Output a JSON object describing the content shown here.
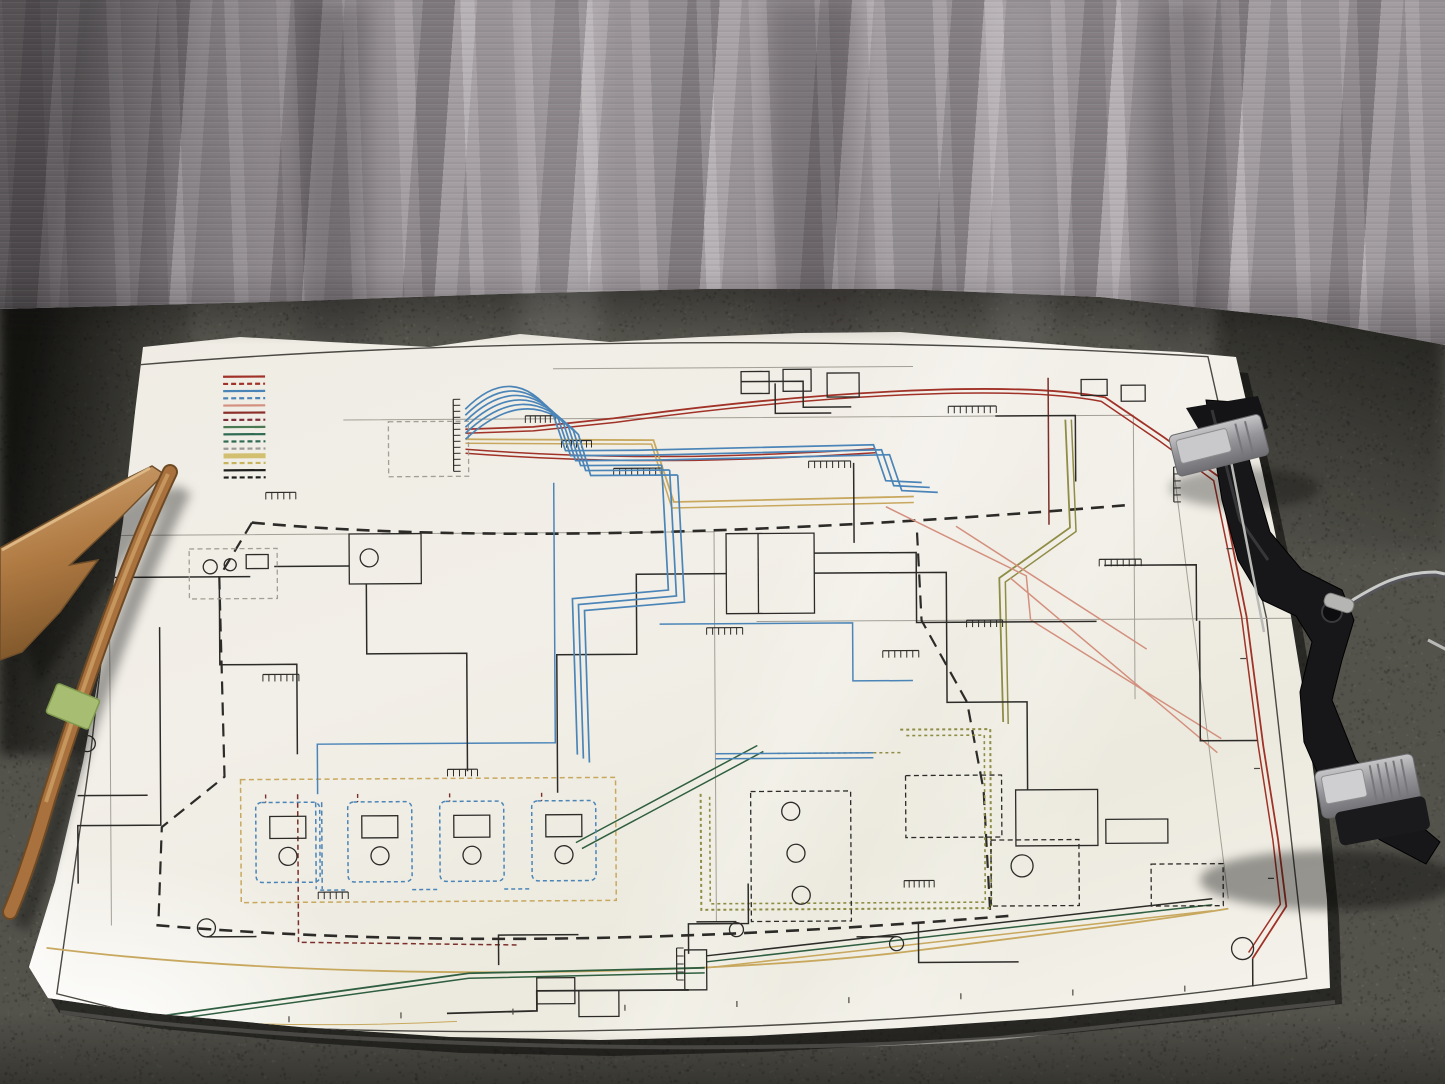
{
  "scene": {
    "type": "photograph",
    "subject": "Large color-coded electrical wiring schematic poster in a glossy plastic sleeve, laid on a dark carpeted floor in front of a gray drape curtain",
    "objects": [
      "wiring schematic poster",
      "gray woven curtain backdrop",
      "dark speckled carpet floor",
      "flat wooden slat",
      "long wooden stick with green tape band",
      "black plastic clamp hanger with two gray metal clips and silver swivel hook wire"
    ]
  },
  "palette": {
    "curtain_base": "#a19b9f",
    "curtain_fold_dark": "#8b8589",
    "curtain_fold_light": "#b3adb1",
    "carpet_base": "#53524b",
    "carpet_dark": "#34332e",
    "carpet_light": "#6b695f",
    "paper": "#f0ede6",
    "frame_line": "#4a4843",
    "wire_red": "#a03228",
    "wire_dark_red": "#7c2f2a",
    "wire_blue": "#4b85b8",
    "wire_tan": "#c8a85e",
    "wire_olive": "#8f8d45",
    "wire_green": "#2f5f40",
    "wire_pink": "#d4907e",
    "wire_black": "#2c2b28",
    "wire_gray": "#a29f96",
    "text_micro": "#8a887f",
    "wood_light": "#d2a877",
    "wood_mid": "#a9713d",
    "wood_dark": "#6e4a24",
    "tape_green": "#a6bd72",
    "hanger_black": "#17171a",
    "clip_metal": "#a8a8aa",
    "hook_metal": "#caccca"
  },
  "poster": {
    "kind": "machine electrical wiring schematic (micro-text illegible at photo resolution)",
    "micro_text_illegible": true,
    "note_blocks_bottom_right": 4,
    "right_side_tables": [
      "wire color code list",
      "symbol description list",
      "parts reference table",
      "cable reference table"
    ],
    "legend_rows": 15,
    "border": {
      "inner_frame": true,
      "tan_accent_line": true,
      "tick_marks": true
    }
  },
  "legend": {
    "entries": [
      {
        "style": "solid",
        "color": "#a03228",
        "lines": 2
      },
      {
        "style": "dash",
        "color": "#a03228",
        "lines": 3
      },
      {
        "style": "solid",
        "color": "#4b85b8",
        "lines": 3
      },
      {
        "style": "dash",
        "color": "#4b85b8",
        "lines": 2
      },
      {
        "style": "solid",
        "color": "#d4907e",
        "lines": 1
      },
      {
        "style": "solid",
        "color": "#8c2f2a",
        "lines": 1
      },
      {
        "style": "dash",
        "color": "#7c2f38",
        "lines": 1
      },
      {
        "style": "solid",
        "color": "#4a7a52",
        "lines": 1
      },
      {
        "style": "solid",
        "color": "#2e6b52",
        "lines": 1
      },
      {
        "style": "dash",
        "color": "#2e6b52",
        "lines": 2
      },
      {
        "style": "dash",
        "color": "#9a9a96",
        "lines": 2
      },
      {
        "style": "thick",
        "color": "#d2c070",
        "lines": 1
      },
      {
        "style": "dash",
        "color": "#c8b35e",
        "lines": 2
      },
      {
        "style": "solid",
        "color": "#1e1e1c",
        "lines": 1
      },
      {
        "style": "dash",
        "color": "#1e1e1c",
        "lines": 1
      }
    ]
  }
}
